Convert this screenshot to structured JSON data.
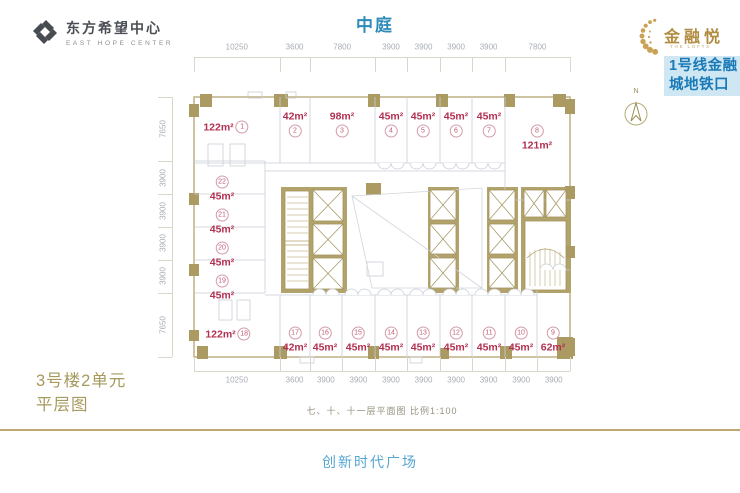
{
  "header": {
    "developer": {
      "cn": "东方希望中心",
      "en": "EAST HOPE CENTER"
    },
    "atrium_label": "中庭",
    "brand": {
      "cn": "金融悦",
      "en": "THE LOFTS"
    },
    "subway_badge": {
      "line1": "1号线金融",
      "line2": "城地铁口"
    },
    "compass_n": "N"
  },
  "plan": {
    "area_unit": "m²",
    "units": [
      {
        "no": "1",
        "area": "122",
        "x": 226,
        "y": 127,
        "layout": "row"
      },
      {
        "no": "2",
        "area": "42",
        "x": 295,
        "y": 124,
        "layout": "col"
      },
      {
        "no": "3",
        "area": "98",
        "x": 342,
        "y": 124,
        "layout": "col"
      },
      {
        "no": "4",
        "area": "45",
        "x": 391,
        "y": 124,
        "layout": "col"
      },
      {
        "no": "5",
        "area": "45",
        "x": 423,
        "y": 124,
        "layout": "col"
      },
      {
        "no": "6",
        "area": "45",
        "x": 456,
        "y": 124,
        "layout": "col"
      },
      {
        "no": "7",
        "area": "45",
        "x": 489,
        "y": 124,
        "layout": "col"
      },
      {
        "no": "8",
        "area": "121",
        "x": 537,
        "y": 138,
        "layout": "circ"
      },
      {
        "no": "9",
        "area": "62",
        "x": 553,
        "y": 340,
        "layout": "circ"
      },
      {
        "no": "10",
        "area": "45",
        "x": 521,
        "y": 340,
        "layout": "circ"
      },
      {
        "no": "11",
        "area": "45",
        "x": 489,
        "y": 340,
        "layout": "circ"
      },
      {
        "no": "12",
        "area": "45",
        "x": 456,
        "y": 340,
        "layout": "circ"
      },
      {
        "no": "13",
        "area": "45",
        "x": 423,
        "y": 340,
        "layout": "circ"
      },
      {
        "no": "14",
        "area": "45",
        "x": 391,
        "y": 340,
        "layout": "circ"
      },
      {
        "no": "15",
        "area": "45",
        "x": 358,
        "y": 340,
        "layout": "circ"
      },
      {
        "no": "16",
        "area": "45",
        "x": 325,
        "y": 340,
        "layout": "circ"
      },
      {
        "no": "17",
        "area": "42",
        "x": 295,
        "y": 340,
        "layout": "circ"
      },
      {
        "no": "18",
        "area": "122",
        "x": 228,
        "y": 334,
        "layout": "row"
      },
      {
        "no": "19",
        "area": "45",
        "x": 222,
        "y": 288,
        "layout": "circ"
      },
      {
        "no": "20",
        "area": "45",
        "x": 222,
        "y": 255,
        "layout": "circ"
      },
      {
        "no": "21",
        "area": "45",
        "x": 222,
        "y": 222,
        "layout": "circ"
      },
      {
        "no": "22",
        "area": "45",
        "x": 222,
        "y": 189,
        "layout": "circ"
      }
    ],
    "dims": {
      "top": [
        10250,
        3600,
        7800,
        3900,
        3900,
        3900,
        3900,
        7800
      ],
      "bottom": [
        10250,
        3600,
        3900,
        3900,
        3900,
        3900,
        3900,
        3900,
        3900,
        3900
      ],
      "left": [
        7650,
        3900,
        3900,
        3900,
        3900,
        7650
      ]
    }
  },
  "footer": {
    "unit_title_line1": "3号楼2单元",
    "unit_title_line2": "平层图",
    "caption": "七、十、十一层平面图  比例1:100",
    "plaza": "创新时代广场"
  },
  "colors": {
    "wall_gold": "#b2a26c",
    "accent_red": "#b23051",
    "title_blue": "#2e8bb8",
    "badge_blue": "#1a7ab8",
    "badge_bg": "#cfe7f3",
    "footer_gold": "#a69a5e",
    "plaza_blue": "#55a6d1"
  }
}
